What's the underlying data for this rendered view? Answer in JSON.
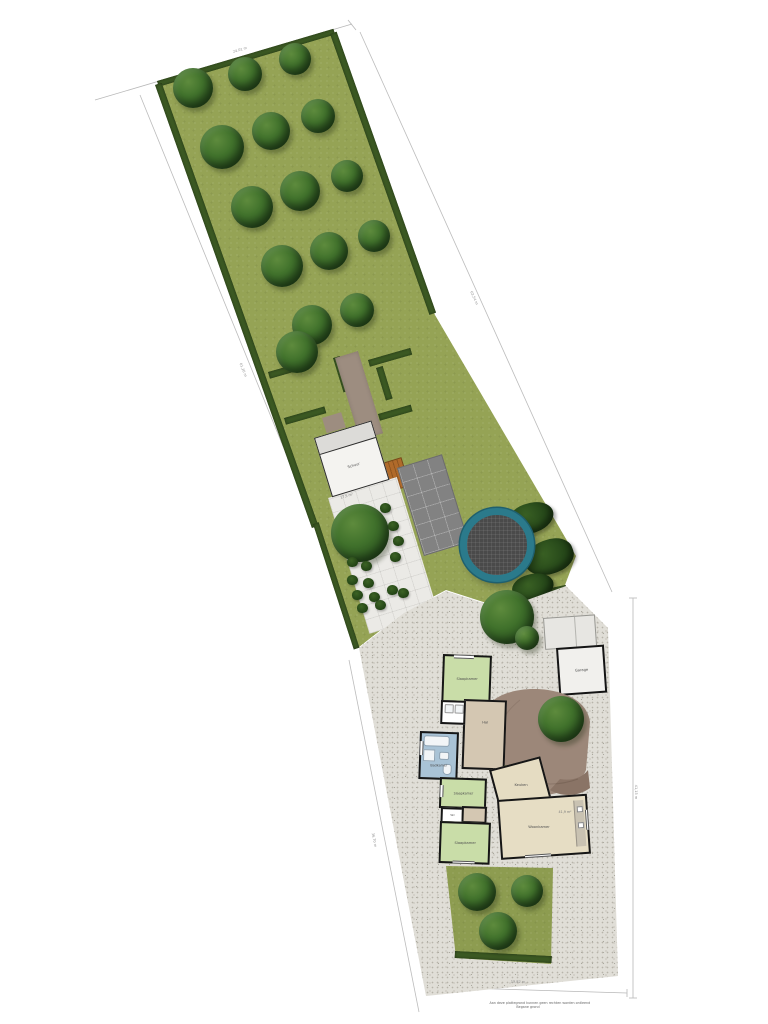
{
  "plan": {
    "caption_line1": "Aan deze plattegrond kunnen geen rechten worden ontleend",
    "caption_line2": "Begane grond"
  },
  "buildings": {
    "schuur": {
      "label": "Schuur",
      "area": "17,5 m²"
    },
    "garage": {
      "label": "Garage"
    }
  },
  "rooms": {
    "bedroom1": "Slaapkamer",
    "hal": "Hal",
    "bathroom": "Badkamer",
    "bedroom2": "Slaapkamer",
    "wc": "Wc",
    "kitchen": "Keuken",
    "living": "Woonkamer",
    "living_area": "41,9 m²",
    "bedroom3": "Slaapkamer"
  },
  "dimensions": {
    "top": "24,01 m",
    "right_upper": "63,54 m",
    "left_upper": "61,26 m",
    "left_lower": "36,70 m",
    "right_lower": "41,15 m",
    "bottom": "19,82 m"
  },
  "colors": {
    "grass": "#95a355",
    "hedge": "#3c5a23",
    "gravel": "#e0ded7",
    "terrace": "#9c8779",
    "trampoline_ring": "#2b7a8b",
    "room_green": "#c9dda8",
    "room_beige": "#e6ddc4",
    "room_tan": "#d4c7b2",
    "room_blue": "#a9c3d6"
  }
}
